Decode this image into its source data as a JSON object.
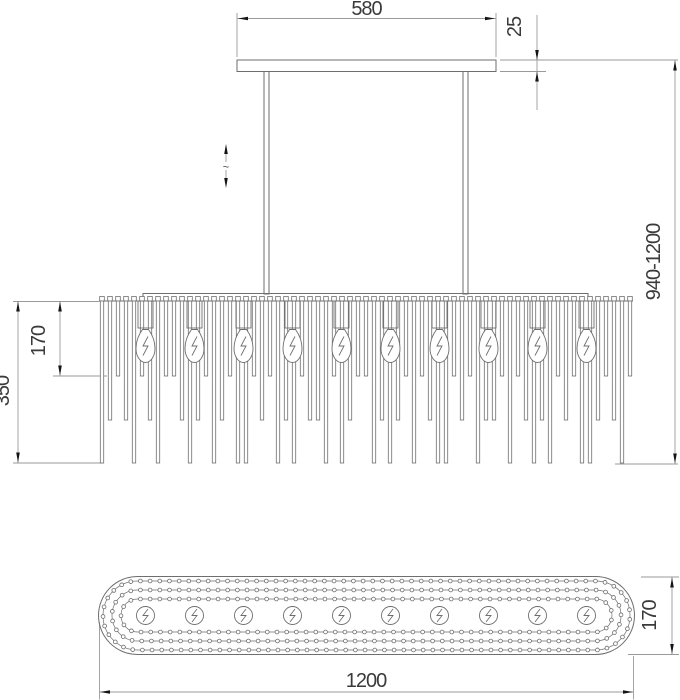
{
  "drawing_title": "chandelier-dimension-drawing",
  "front_view": {
    "dim_canopy_width": "580",
    "dim_canopy_thickness": "25",
    "dim_overall_height": "940-1200",
    "dim_first_tier_drop": "170",
    "dim_body_drop": "350",
    "adjustable_symbol": "~",
    "bulb_count": 10,
    "rod_count": 67,
    "rod_tier_pattern": [
      2,
      1,
      0,
      1,
      2,
      0,
      1,
      2,
      0,
      0,
      1,
      2,
      1,
      0,
      2,
      1,
      0,
      2,
      2,
      0,
      1,
      0,
      2,
      1,
      2,
      0,
      1,
      1,
      2,
      0,
      2,
      1,
      0,
      0,
      2,
      1,
      2,
      1,
      0,
      2,
      0,
      1,
      2,
      2,
      0,
      1,
      0,
      2,
      1,
      1,
      0,
      2,
      0,
      1,
      2,
      1,
      2,
      0,
      1,
      0,
      2,
      2,
      1,
      0,
      1,
      2,
      0
    ]
  },
  "bottom_view": {
    "dim_length": "1200",
    "dim_width": "170",
    "bulb_count": 10,
    "bead_ring_count": 3
  },
  "symbols": {
    "bulb_symbol": "lightning-bolt-icon",
    "height_adjust_symbol": "vertical-double-arrow-tilde-icon"
  },
  "colors": {
    "background": "#ffffff",
    "object_line": "#6e6e6e",
    "dimension_line": "#9a9a9a",
    "arrow": "#141414",
    "text": "#3a3a3a"
  }
}
